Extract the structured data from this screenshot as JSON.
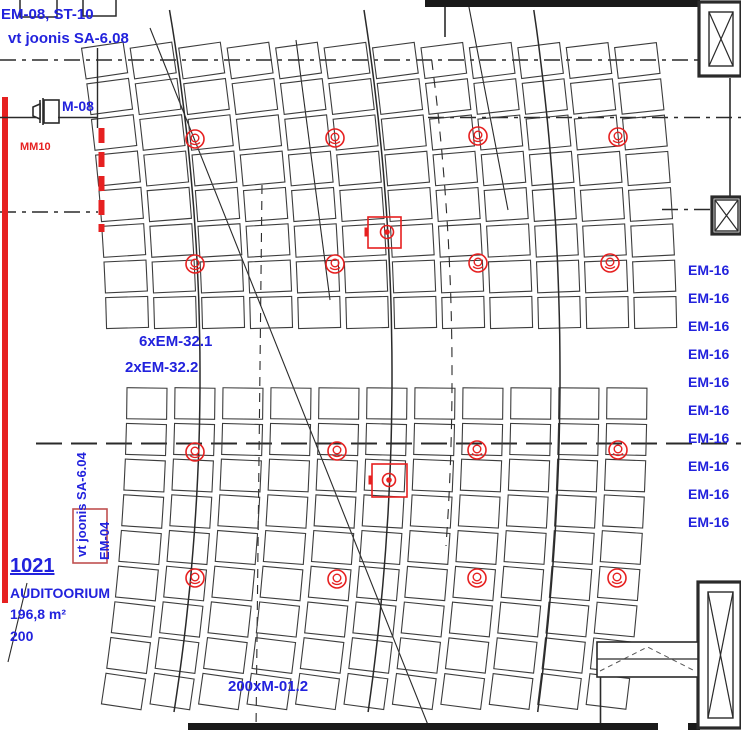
{
  "drawing": {
    "labels": {
      "top_line1": "EM-08, ST-10",
      "top_line2": "vt joonis SA-6.08",
      "m08": "M-08",
      "mm10": "MM10",
      "em32_line1": "6xEM-32.1",
      "em32_line2": "2xEM-32.2",
      "sa604": "vt joonis SA-6.04",
      "em04": "EM-04",
      "m012": "200xM-01.2",
      "room": {
        "number": "1021",
        "name": "AUDITOORIUM",
        "area": "196,8 m²",
        "capacity": "200"
      },
      "em16_items": [
        "EM-16",
        "EM-16",
        "EM-16",
        "EM-16",
        "EM-16",
        "EM-16",
        "EM-16",
        "EM-16",
        "EM-16",
        "EM-16"
      ]
    },
    "colors": {
      "annotation_blue": "#2222dd",
      "annotation_red": "#e62020",
      "line_dark": "#2a2a2a",
      "seat_stroke": "#3c3c3c"
    },
    "seating": {
      "arc_center": {
        "x": -2000,
        "y": 375
      },
      "blocks": [
        {
          "name": "upper-block",
          "col_start": 128,
          "col_step": 48,
          "col_count": 12,
          "row_y0": 45,
          "row_step": 36,
          "row_count": 8,
          "seat_w": 42,
          "seat_h": 31
        },
        {
          "name": "lower-block",
          "col_start": 147,
          "col_step": 48,
          "col_count": 11,
          "row_y0": 388,
          "row_step": 36,
          "row_count": 9,
          "seat_w": 40,
          "seat_h": 31
        }
      ]
    },
    "aisle_arcs": [
      {
        "mid_x": 200,
        "y1": 10,
        "y2": 726,
        "dashed": false
      },
      {
        "mid_x": 392,
        "y1": 10,
        "y2": 726,
        "dashed": false
      },
      {
        "mid_x": 560,
        "y1": 10,
        "y2": 726,
        "dashed": false
      },
      {
        "mid_x": 452,
        "y1": 60,
        "y2": 560,
        "dashed": true
      }
    ],
    "axis_lines": [
      {
        "y": 60,
        "x1": 0,
        "x2": 698,
        "w": 1.4,
        "dash": "16,6,4,6"
      },
      {
        "y": 117.5,
        "x1": 428,
        "x2": 741,
        "w": 1.4,
        "dash": "16,6,4,6"
      },
      {
        "y": 212,
        "x1": 0,
        "x2": 98,
        "w": 1.4,
        "dash": "16,6,4,6"
      },
      {
        "y": 209.5,
        "x1": 662,
        "x2": 712,
        "w": 1.4,
        "dash": "16,6,4,6"
      },
      {
        "y": 443.5,
        "x1": 36,
        "x2": 741,
        "w": 2,
        "dash": "26,9"
      }
    ],
    "stray_lines": [
      {
        "x1": 296,
        "y1": 40,
        "x2": 330,
        "y2": 300,
        "dash": null
      },
      {
        "x1": 468,
        "y1": 2,
        "x2": 508,
        "y2": 210,
        "dash": null
      },
      {
        "x1": 150,
        "y1": 28,
        "x2": 430,
        "y2": 730,
        "dash": null
      },
      {
        "x1": 27,
        "y1": 583,
        "x2": 8,
        "y2": 662,
        "dash": null
      },
      {
        "x1": 262,
        "y1": 185,
        "x2": 256,
        "y2": 730,
        "dash": "9,7"
      }
    ],
    "symbols": {
      "speakers": [
        [
          195,
          139
        ],
        [
          335,
          138
        ],
        [
          478,
          136
        ],
        [
          618,
          137
        ],
        [
          195,
          264
        ],
        [
          335,
          264
        ],
        [
          478,
          263
        ],
        [
          610,
          263
        ],
        [
          195,
          452
        ],
        [
          337,
          451
        ],
        [
          477,
          450
        ],
        [
          618,
          450
        ],
        [
          195,
          578
        ],
        [
          337,
          579
        ],
        [
          477,
          578
        ],
        [
          617,
          578
        ]
      ],
      "devices": [
        {
          "x": 368,
          "y": 217,
          "w": 33,
          "h": 31,
          "cx": 387,
          "cy": 232
        },
        {
          "x": 372,
          "y": 464,
          "w": 35,
          "h": 33,
          "cx": 389,
          "cy": 480
        }
      ],
      "em04_box": {
        "x": 73,
        "y": 509,
        "w": 34,
        "h": 54
      },
      "red_bar": {
        "x": 2,
        "y": 97,
        "w": 6,
        "h": 506
      },
      "red_dash_strip": {
        "x": 101.5,
        "y1": 128,
        "y2": 232,
        "w": 6,
        "dash": "15,9"
      }
    },
    "structures": {
      "top_rects": [
        {
          "x": 20,
          "y": -4,
          "w": 37,
          "h": 21
        },
        {
          "x": 83,
          "y": -4,
          "w": 33,
          "h": 20
        }
      ],
      "walls": [
        {
          "x1": 97.5,
          "y1": 48,
          "x2": 97.5,
          "y2": 128,
          "w": 1.4
        },
        {
          "x1": 0,
          "y1": 117.5,
          "x2": 36,
          "y2": 117.5,
          "w": 1.4
        },
        {
          "x1": 58,
          "y1": 117.5,
          "x2": 97,
          "y2": 117.5,
          "w": 1.4
        },
        {
          "x1": 445,
          "y1": 0,
          "x2": 445,
          "y2": 37,
          "w": 1.6
        },
        {
          "x1": 730,
          "y1": 78,
          "x2": 730,
          "y2": 197,
          "w": 1.6
        },
        {
          "x1": 600.5,
          "y1": 677,
          "x2": 600.5,
          "y2": 729,
          "w": 1.6
        }
      ],
      "top_wall_band": {
        "x": 425,
        "y": 0,
        "w": 275,
        "h": 7
      },
      "bottom_wall_segments": [
        {
          "x": 188,
          "w": 470
        },
        {
          "x": 688,
          "w": 12
        }
      ],
      "x_boxes": [
        {
          "x": 699,
          "y": 2,
          "w": 42,
          "h": 74,
          "inner": true
        },
        {
          "x": 712,
          "y": 197,
          "w": 29,
          "h": 37,
          "inner": false
        },
        {
          "x": 698,
          "y": 582,
          "w": 43,
          "h": 146,
          "inner": true
        }
      ],
      "counter": {
        "x": 597,
        "y": 642,
        "w": 101,
        "h": 35,
        "mid_y": 659
      }
    }
  }
}
